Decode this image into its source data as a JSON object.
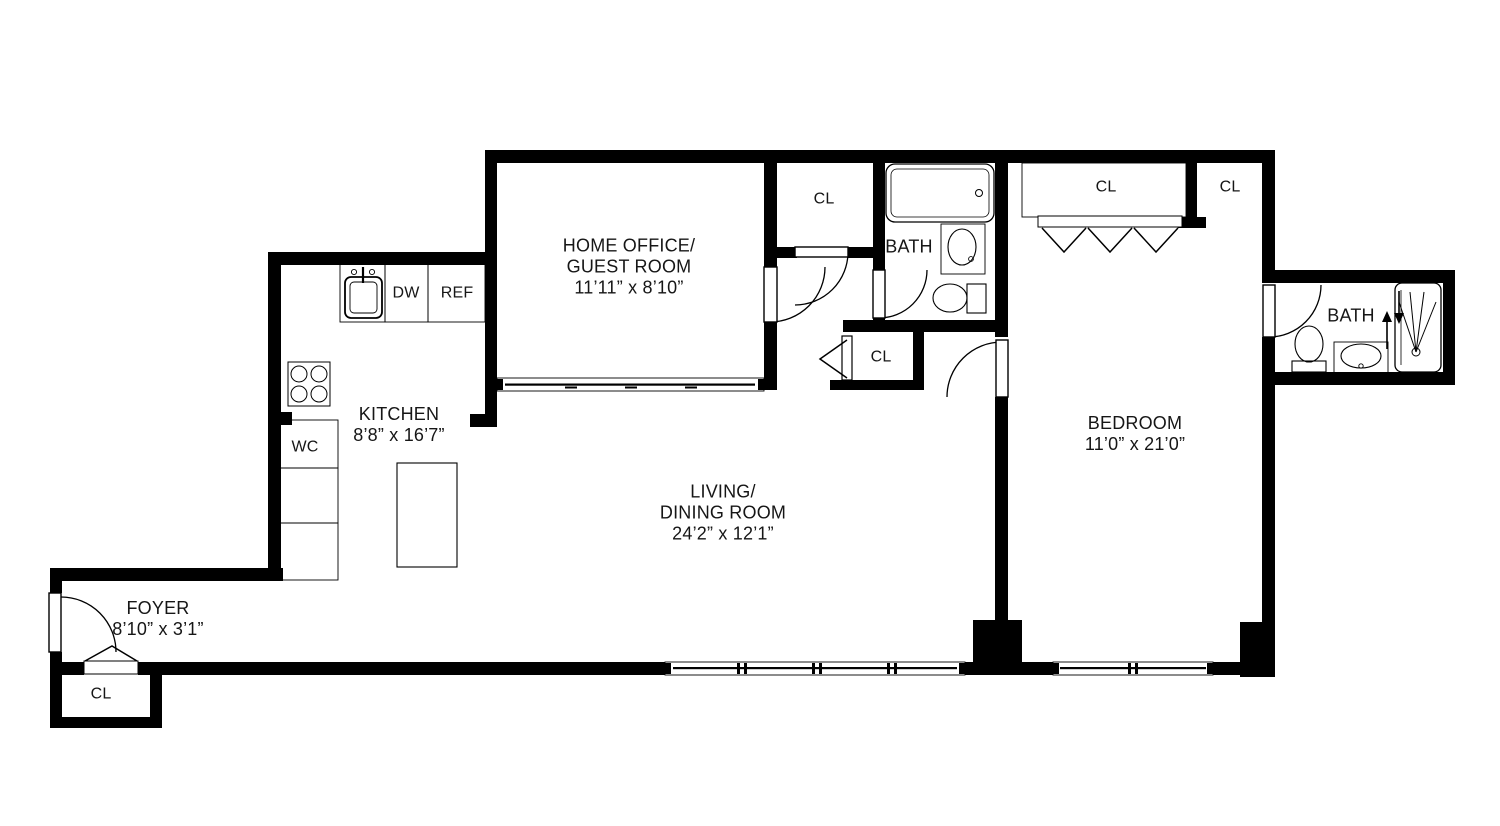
{
  "title": "Apartment floor plan",
  "colors": {
    "walls": "#000000",
    "lines": "#1a1a1a",
    "background": "#ffffff",
    "text": "#161616"
  },
  "rooms": {
    "home_office": {
      "line1": "HOME OFFICE/",
      "line2": "GUEST ROOM",
      "dims": "11’11” x 8’10”"
    },
    "living_dining": {
      "line1": "LIVING/",
      "line2": "DINING ROOM",
      "dims": "24’2” x 12’1”"
    },
    "bedroom": {
      "name": "BEDROOM",
      "dims": "11’0” x 21’0”"
    },
    "kitchen": {
      "name": "KITCHEN",
      "dims": "8’8” x 16’7”"
    },
    "foyer": {
      "name": "FOYER",
      "dims": "8’10” x 3’1”"
    },
    "hall_bath": {
      "name": "BATH"
    },
    "ensuite_bath": {
      "name": "BATH"
    },
    "water_closet": {
      "name": "WC"
    }
  },
  "closets": {
    "hall_upper": "CL",
    "hall_lower": "CL",
    "bedroom_wide": "CL",
    "bedroom_corner": "CL",
    "foyer": "CL"
  },
  "appliances": {
    "dishwasher": "DW",
    "refrigerator": "REF"
  }
}
